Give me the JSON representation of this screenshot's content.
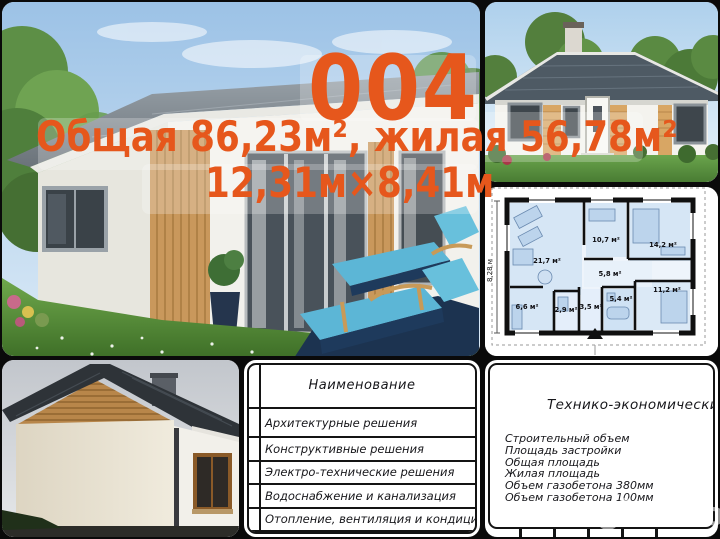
{
  "overlay": {
    "project_number": "004",
    "area_line": "Общая 86,23м², жилая 56,78м²",
    "dimensions_line": "12,31м×8,41м"
  },
  "floor_plan": {
    "height_dimension": "8,28 м",
    "rooms": [
      {
        "label": "21,7 м²"
      },
      {
        "label": "10,7 м²"
      },
      {
        "label": "14,2 м²"
      },
      {
        "label": "5,8 м²"
      },
      {
        "label": "11,2 м²"
      },
      {
        "label": "5,4 м²"
      },
      {
        "label": "3,5 м²"
      },
      {
        "label": "2,9 м²"
      },
      {
        "label": "6,6 м²"
      }
    ]
  },
  "spec_table": {
    "header": "Наименование",
    "rows": [
      "Архитектурные решения",
      "Конструктивные решения",
      "Электро-технические решения",
      "Водоснабжение и канализация",
      "Отопление, вентиляция и кондиционирование"
    ]
  },
  "tech_panel": {
    "title": "Технико-экономические показатели",
    "items": [
      "Строительный объем",
      "Площадь застройки",
      "Общая площадь",
      "Жилая площадь",
      "Объем газобетона 380мм",
      "Объем газобетона 100мм"
    ]
  },
  "watermark": {
    "text": "Avito"
  },
  "colors": {
    "accent": "#e6571c",
    "plan_fill": "#d6e6f5",
    "lounger_teal": "#5cb6d6"
  }
}
